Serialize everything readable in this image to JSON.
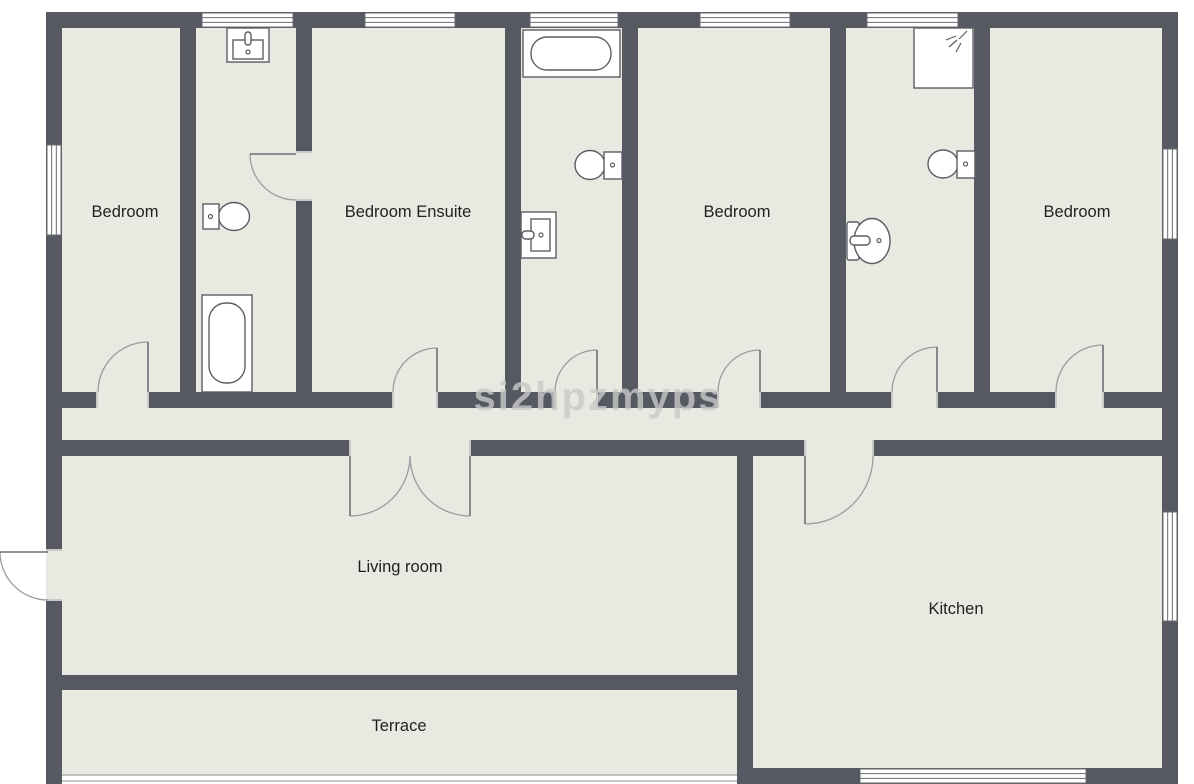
{
  "plan": {
    "canvas": {
      "w": 1194,
      "h": 784
    },
    "watermark": {
      "text": "si2hpzmyps",
      "x": 598,
      "y": 410,
      "font_size": 40,
      "color": "#c8c8c8",
      "opacity": 0.8
    },
    "colors": {
      "wall": "#575962",
      "floor": "#e9e8e1",
      "outside": "#ffffff",
      "window_frame": "#696b72",
      "fixture": "#5b5d64",
      "door_panel": "#6d6f75",
      "door_arc": "#9b9ca0",
      "jamb": "#c9c9c9",
      "label": "#1f2022",
      "terrace_edge": "#c0c0c0",
      "ground_line": "#c6c6c6"
    },
    "floor": {
      "x": 62,
      "y": 28,
      "w": 1100,
      "h": 748
    },
    "rooms": [
      {
        "n": "room-label-bedroom-1",
        "label": "Bedroom",
        "x": 125,
        "y": 217,
        "fs": 16.5
      },
      {
        "n": "room-label-bedroom-ensuite",
        "label": "Bedroom Ensuite",
        "x": 408,
        "y": 217,
        "fs": 16.5
      },
      {
        "n": "room-label-bedroom-3",
        "label": "Bedroom",
        "x": 737,
        "y": 217,
        "fs": 16.5
      },
      {
        "n": "room-label-bedroom-4",
        "label": "Bedroom",
        "x": 1077,
        "y": 217,
        "fs": 16.5
      },
      {
        "n": "room-label-living-room",
        "label": "Living room",
        "x": 400,
        "y": 572,
        "fs": 16.5
      },
      {
        "n": "room-label-kitchen",
        "label": "Kitchen",
        "x": 956,
        "y": 614,
        "fs": 16.5
      },
      {
        "n": "room-label-terrace",
        "label": "Terrace",
        "x": 399,
        "y": 731,
        "fs": 16.5
      }
    ],
    "walls": [
      {
        "n": "exterior-top-wall",
        "x": 46,
        "y": 12,
        "w": 1132,
        "h": 16
      },
      {
        "n": "exterior-left-wall-upper",
        "x": 46,
        "y": 12,
        "w": 16,
        "h": 538
      },
      {
        "n": "exterior-left-wall-lower",
        "x": 46,
        "y": 600,
        "w": 16,
        "h": 184
      },
      {
        "n": "exterior-right-wall",
        "x": 1162,
        "y": 12,
        "w": 16,
        "h": 772
      },
      {
        "n": "kitchen-bottom-wall",
        "x": 737,
        "y": 768,
        "w": 441,
        "h": 16
      },
      {
        "n": "wall-bedroom1-bathroom1",
        "x": 180,
        "y": 28,
        "w": 16,
        "h": 364
      },
      {
        "n": "wall-bathroom1-ensuite-upper",
        "x": 296,
        "y": 28,
        "w": 16,
        "h": 124
      },
      {
        "n": "wall-bathroom1-ensuite-lower",
        "x": 296,
        "y": 200,
        "w": 16,
        "h": 192
      },
      {
        "n": "wall-ensuite-bathroom2",
        "x": 505,
        "y": 28,
        "w": 16,
        "h": 364
      },
      {
        "n": "wall-bathroom2-bedroom3",
        "x": 622,
        "y": 28,
        "w": 16,
        "h": 364
      },
      {
        "n": "wall-bedroom3-bathroom3",
        "x": 830,
        "y": 28,
        "w": 16,
        "h": 364
      },
      {
        "n": "wall-bathroom3-bedroom4",
        "x": 974,
        "y": 28,
        "w": 16,
        "h": 364
      },
      {
        "n": "hallway-top-wall-seg1",
        "x": 62,
        "y": 392,
        "w": 35,
        "h": 16
      },
      {
        "n": "hallway-top-wall-seg2",
        "x": 148,
        "y": 392,
        "w": 245,
        "h": 16
      },
      {
        "n": "hallway-top-wall-seg3",
        "x": 437,
        "y": 392,
        "w": 118,
        "h": 16
      },
      {
        "n": "hallway-top-wall-seg4",
        "x": 597,
        "y": 392,
        "w": 121,
        "h": 16
      },
      {
        "n": "hallway-top-wall-seg5",
        "x": 760,
        "y": 392,
        "w": 132,
        "h": 16
      },
      {
        "n": "hallway-top-wall-seg6",
        "x": 937,
        "y": 392,
        "w": 119,
        "h": 16
      },
      {
        "n": "hallway-top-wall-seg7",
        "x": 1103,
        "y": 392,
        "w": 59,
        "h": 16
      },
      {
        "n": "hallway-bottom-wall-seg1",
        "x": 62,
        "y": 440,
        "w": 288,
        "h": 16
      },
      {
        "n": "hallway-bottom-wall-seg2",
        "x": 470,
        "y": 440,
        "w": 335,
        "h": 16
      },
      {
        "n": "hallway-bottom-wall-seg3",
        "x": 873,
        "y": 440,
        "w": 289,
        "h": 16
      },
      {
        "n": "wall-living-kitchen",
        "x": 737,
        "y": 456,
        "w": 16,
        "h": 312
      },
      {
        "n": "wall-living-terrace",
        "x": 62,
        "y": 675,
        "w": 675,
        "h": 15
      }
    ],
    "windows": [
      {
        "n": "window-top-bathroom1",
        "x": 202,
        "y": 13,
        "w": 91,
        "h": 14,
        "o": "h"
      },
      {
        "n": "window-top-ensuite",
        "x": 365,
        "y": 13,
        "w": 90,
        "h": 14,
        "o": "h"
      },
      {
        "n": "window-top-bathroom2",
        "x": 530,
        "y": 13,
        "w": 88,
        "h": 14,
        "o": "h"
      },
      {
        "n": "window-top-bedroom3",
        "x": 700,
        "y": 13,
        "w": 90,
        "h": 14,
        "o": "h"
      },
      {
        "n": "window-top-bathroom3",
        "x": 867,
        "y": 13,
        "w": 91,
        "h": 14,
        "o": "h"
      },
      {
        "n": "window-left-bedroom1",
        "x": 47,
        "y": 145,
        "w": 14,
        "h": 90,
        "o": "v"
      },
      {
        "n": "window-right-bedroom4",
        "x": 1163,
        "y": 149,
        "w": 14,
        "h": 90,
        "o": "v"
      },
      {
        "n": "window-right-kitchen",
        "x": 1163,
        "y": 512,
        "w": 14,
        "h": 109,
        "o": "v"
      },
      {
        "n": "window-bottom-kitchen",
        "x": 860,
        "y": 769,
        "w": 226,
        "h": 14,
        "o": "h"
      }
    ],
    "door_gaps": [
      {
        "n": "gap-bedroom1-door",
        "x": 97,
        "y": 392,
        "w": 51,
        "h": 16,
        "o": "v"
      },
      {
        "n": "gap-ensuite-door",
        "x": 393,
        "y": 392,
        "w": 44,
        "h": 16,
        "o": "v"
      },
      {
        "n": "gap-bathroom2-door",
        "x": 555,
        "y": 392,
        "w": 42,
        "h": 16,
        "o": "v"
      },
      {
        "n": "gap-bedroom3-door",
        "x": 718,
        "y": 392,
        "w": 42,
        "h": 16,
        "o": "v"
      },
      {
        "n": "gap-bathroom3-door",
        "x": 892,
        "y": 392,
        "w": 45,
        "h": 16,
        "o": "v"
      },
      {
        "n": "gap-bedroom4-door",
        "x": 1056,
        "y": 392,
        "w": 47,
        "h": 16,
        "o": "v"
      },
      {
        "n": "gap-bathroom1-door",
        "x": 296,
        "y": 152,
        "w": 16,
        "h": 48,
        "o": "h"
      },
      {
        "n": "gap-living-door",
        "x": 350,
        "y": 440,
        "w": 120,
        "h": 16,
        "o": "v"
      },
      {
        "n": "gap-kitchen-door",
        "x": 805,
        "y": 440,
        "w": 68,
        "h": 16,
        "o": "v"
      },
      {
        "n": "gap-front-door",
        "x": 46,
        "y": 550,
        "w": 16,
        "h": 50,
        "o": "h"
      }
    ],
    "doors": [
      {
        "n": "bedroom1-door",
        "panel": [
          148,
          392,
          148,
          342
        ],
        "arc": "M98,392 A50,50 0 0 1 148,342"
      },
      {
        "n": "ensuite-door",
        "panel": [
          437,
          392,
          437,
          348
        ],
        "arc": "M393,392 A44,44 0 0 1 437,348"
      },
      {
        "n": "bathroom2-door",
        "panel": [
          597,
          392,
          597,
          350
        ],
        "arc": "M555,392 A42,42 0 0 1 597,350"
      },
      {
        "n": "bedroom3-door",
        "panel": [
          760,
          392,
          760,
          350
        ],
        "arc": "M718,392 A42,42 0 0 1 760,350"
      },
      {
        "n": "bathroom3-door",
        "panel": [
          937,
          392,
          937,
          347
        ],
        "arc": "M892,392 A45,45 0 0 1 937,347"
      },
      {
        "n": "bedroom4-door",
        "panel": [
          1103,
          392,
          1103,
          345
        ],
        "arc": "M1056,392 A47,47 0 0 1 1103,345"
      },
      {
        "n": "bathroom1-door",
        "panel": [
          296,
          154,
          250,
          154
        ],
        "arc": "M250,154 A46,46 0 0 0 296,200"
      },
      {
        "n": "living-door-left",
        "panel": [
          350,
          456,
          350,
          516
        ],
        "arc": "M410,456 A60,60 0 0 1 350,516"
      },
      {
        "n": "living-door-right",
        "panel": [
          470,
          456,
          470,
          516
        ],
        "arc": "M410,456 A60,60 0 0 0 470,516"
      },
      {
        "n": "kitchen-door",
        "panel": [
          805,
          456,
          805,
          524
        ],
        "arc": "M873,456 A68,68 0 0 1 805,524"
      },
      {
        "n": "front-door",
        "panel": [
          48,
          552,
          0,
          552
        ],
        "arc": "M0,552 A48,48 0 0 0 48,600"
      }
    ],
    "fixtures": [
      {
        "n": "bathroom1-sink",
        "shapes": [
          {
            "k": "r",
            "x": 227,
            "y": 28,
            "w": 42,
            "h": 34
          },
          {
            "k": "r",
            "x": 233,
            "y": 40,
            "w": 30,
            "h": 19
          },
          {
            "k": "r",
            "x": 245,
            "y": 32,
            "w": 6,
            "h": 13,
            "rx": 3
          },
          {
            "k": "c",
            "cx": 248,
            "cy": 52,
            "r": 2
          }
        ]
      },
      {
        "n": "bathroom1-toilet",
        "shapes": [
          {
            "k": "e",
            "cx": 234,
            "cy": 216.5,
            "rx": 15.5,
            "ry": 14
          },
          {
            "k": "r",
            "x": 203,
            "y": 204,
            "w": 16,
            "h": 25
          },
          {
            "k": "c",
            "cx": 210.5,
            "cy": 216.5,
            "r": 2
          }
        ]
      },
      {
        "n": "bathroom1-bathtub",
        "shapes": [
          {
            "k": "r",
            "x": 202,
            "y": 295,
            "w": 50,
            "h": 97
          },
          {
            "k": "r",
            "x": 209,
            "y": 303,
            "w": 36,
            "h": 80,
            "rx": 17
          }
        ]
      },
      {
        "n": "bathroom2-bathtub",
        "shapes": [
          {
            "k": "r",
            "x": 523,
            "y": 30,
            "w": 97,
            "h": 47
          },
          {
            "k": "r",
            "x": 531,
            "y": 37,
            "w": 80,
            "h": 33,
            "rx": 16
          }
        ]
      },
      {
        "n": "bathroom2-toilet",
        "shapes": [
          {
            "k": "e",
            "cx": 590,
            "cy": 165,
            "rx": 15,
            "ry": 14.5
          },
          {
            "k": "r",
            "x": 604,
            "y": 152,
            "w": 18,
            "h": 27
          },
          {
            "k": "c",
            "cx": 612.5,
            "cy": 165,
            "r": 2
          }
        ]
      },
      {
        "n": "bathroom2-sink",
        "shapes": [
          {
            "k": "r",
            "x": 521,
            "y": 212,
            "w": 35,
            "h": 46
          },
          {
            "k": "r",
            "x": 531,
            "y": 219,
            "w": 19,
            "h": 32
          },
          {
            "k": "r",
            "x": 522,
            "y": 231,
            "w": 12,
            "h": 8,
            "rx": 3.5
          },
          {
            "k": "c",
            "cx": 541,
            "cy": 235,
            "r": 2
          }
        ]
      },
      {
        "n": "bathroom3-shower",
        "shapes": [
          {
            "k": "r",
            "x": 914,
            "y": 28,
            "w": 59,
            "h": 60
          },
          {
            "k": "l",
            "x1": 967,
            "y1": 31,
            "x2": 959,
            "y2": 39
          },
          {
            "k": "l",
            "x1": 956,
            "y1": 36,
            "x2": 946,
            "y2": 40
          },
          {
            "k": "l",
            "x1": 957,
            "y1": 40,
            "x2": 949,
            "y2": 47
          },
          {
            "k": "l",
            "x1": 961,
            "y1": 43,
            "x2": 956,
            "y2": 52
          }
        ]
      },
      {
        "n": "bathroom3-toilet",
        "shapes": [
          {
            "k": "e",
            "cx": 943,
            "cy": 164,
            "rx": 15,
            "ry": 14
          },
          {
            "k": "r",
            "x": 957,
            "y": 151,
            "w": 18,
            "h": 27
          },
          {
            "k": "c",
            "cx": 965.5,
            "cy": 164,
            "r": 2
          }
        ]
      },
      {
        "n": "bathroom3-sink",
        "shapes": [
          {
            "k": "r",
            "x": 847,
            "y": 222,
            "w": 12,
            "h": 38,
            "rx": 2
          },
          {
            "k": "e",
            "cx": 872,
            "cy": 241,
            "rx": 18,
            "ry": 22.5
          },
          {
            "k": "r",
            "x": 850,
            "y": 236,
            "w": 20,
            "h": 9,
            "rx": 4
          },
          {
            "k": "c",
            "cx": 879,
            "cy": 240.5,
            "r": 2
          }
        ]
      }
    ],
    "misc_lines": [
      {
        "n": "ground-shadow-line",
        "x1": 46,
        "y1": 781,
        "x2": 1178,
        "y2": 781,
        "c": "ground_line",
        "w": 2
      },
      {
        "n": "terrace-open-edge",
        "x1": 62,
        "y1": 775,
        "x2": 737,
        "y2": 775,
        "c": "terrace_edge",
        "w": 2
      }
    ]
  }
}
